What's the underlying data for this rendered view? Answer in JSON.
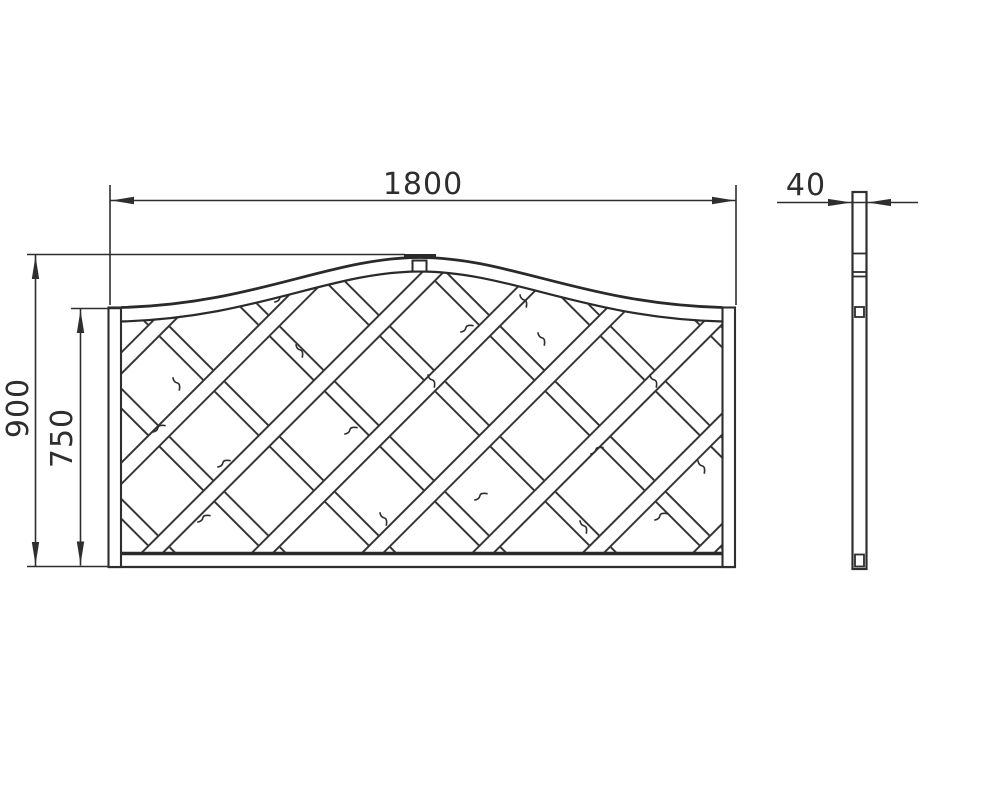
{
  "page": {
    "background_color": "#ffffff",
    "line_color": "#2e2e2e",
    "description": "Technical dimension drawing of a wavy-top lattice trellis fence panel, front view and side profile"
  },
  "drawing": {
    "front_view": {
      "width_label": "1800",
      "overall_height_label": "900",
      "lattice_height_label": "750"
    },
    "side_view": {
      "thickness_label": "40"
    }
  }
}
